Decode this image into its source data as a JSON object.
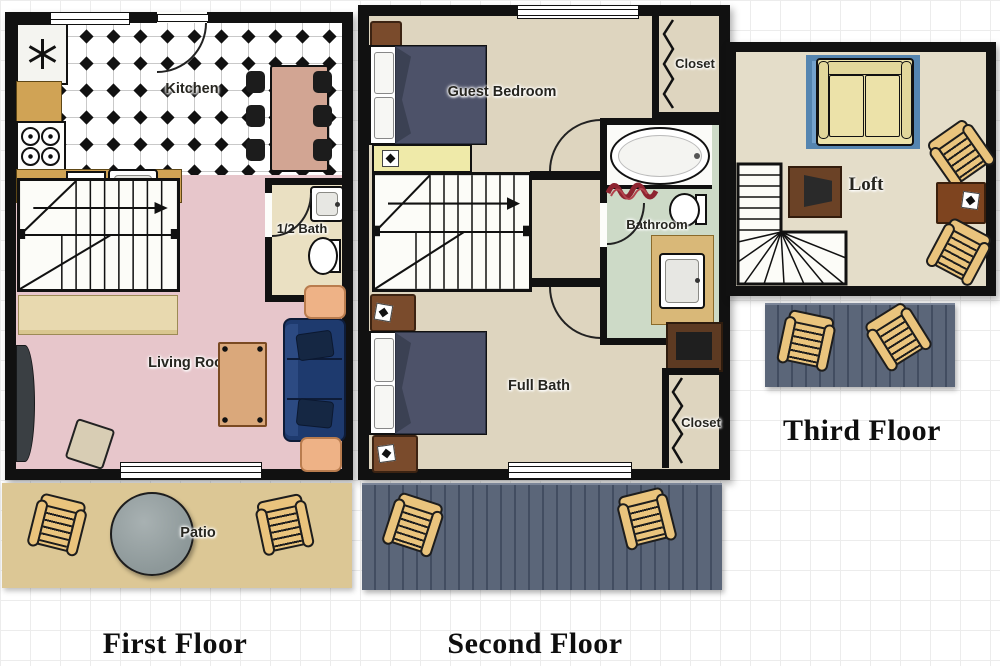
{
  "floors": [
    {
      "title": "First Floor",
      "rooms": {
        "kitchen": "Kitchen",
        "half_bath": "1/2 Bath",
        "living_room": "Living Room",
        "patio": "Patio"
      }
    },
    {
      "title": "Second Floor",
      "rooms": {
        "guest_bedroom": "Guest Bedroom",
        "closet_top": "Closet",
        "bathroom": "Bathroom",
        "full_bath": "Full Bath",
        "closet_bottom": "Closet"
      }
    },
    {
      "title": "Third Floor",
      "rooms": {
        "loft": "Loft"
      }
    }
  ],
  "colors": {
    "wall": "#111111",
    "kitchen_tile": "#ffffff",
    "living_room_floor": "#e7c6cb",
    "half_bath_floor": "#eae0c2",
    "bedroom_floor": "#ded5bf",
    "bathroom_floor": "#cddac7",
    "loft_floor": "#e4ddc9",
    "patio": "#dcc795",
    "deck": "#5b6679",
    "counter": "#d0a355",
    "sofa_navy": "#1e3a6e",
    "bed_cover": "#4d5269",
    "wood_chair": "#eac47d",
    "brown_furniture": "#7a4b2c",
    "loft_rug": "#74a2cc",
    "loft_sofa": "#ece2a9",
    "bath_rug_red": "#8e2430"
  },
  "icons": {
    "fridge_fan": "asterisk-fan",
    "stove": "four-burners",
    "closet_rod": "zigzag",
    "stair_direction": "arrow",
    "bath_rug": "red-squiggle"
  }
}
